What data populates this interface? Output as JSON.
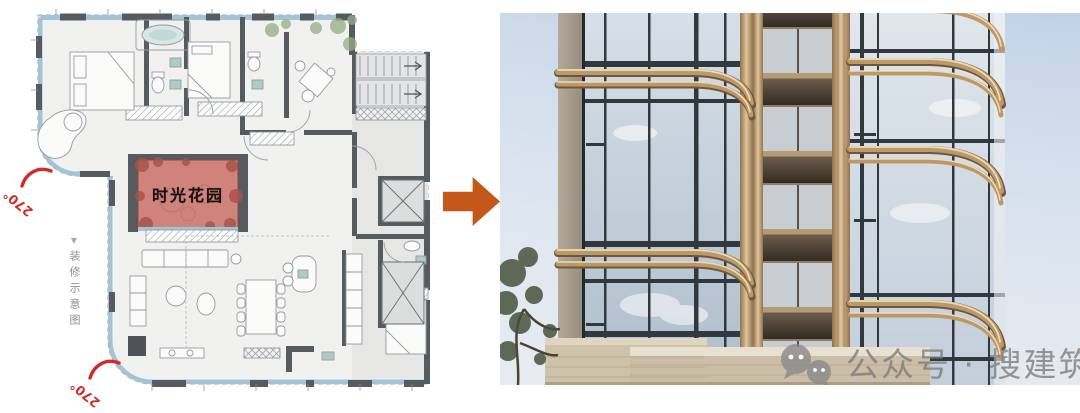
{
  "plan": {
    "garden_label": "时光花园",
    "side_note_marker": "▼",
    "side_note": "装修示意图",
    "angle_labels": [
      {
        "text": "270°"
      },
      {
        "text": "270°"
      }
    ],
    "colors": {
      "highlight_patch": "#cf837c",
      "glazing_band": "#a4c4d5",
      "wall": "#565b60",
      "angle_red": "#d22c26",
      "floor": "#f1f1ef"
    }
  },
  "arrow": {
    "direction": "right",
    "color": "#c4571a"
  },
  "photo": {
    "colors": {
      "sky": "#c9d6e7",
      "bronze_band": "#bb9968",
      "glass": "#cfd9e2",
      "podium": "#cbbda6"
    }
  },
  "watermark": {
    "icon": "wechat-icon",
    "text": "公众号 · 搜建筑",
    "color": "#8a8a8a"
  }
}
